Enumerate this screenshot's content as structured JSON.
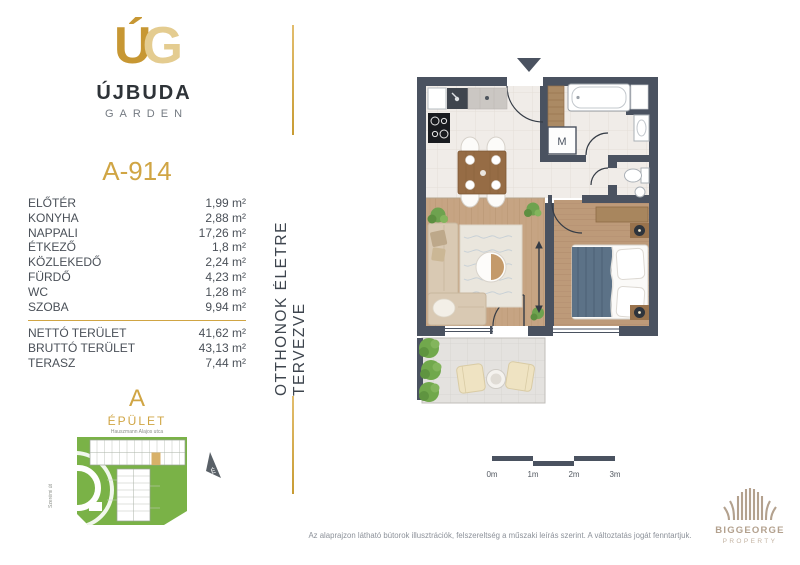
{
  "brand": {
    "monogram": [
      "Ú",
      "G"
    ],
    "name": "ÚJBUDA",
    "sub": "GARDEN"
  },
  "tagline": "OTTHONOK ÉLETRE TERVEZVE",
  "unit": {
    "id": "A-914",
    "rooms": [
      {
        "label": "ELŐTÉR",
        "area": "1,99 m²"
      },
      {
        "label": "KONYHA",
        "area": "2,88 m²"
      },
      {
        "label": "NAPPALI",
        "area": "17,26 m²"
      },
      {
        "label": "ÉTKEZŐ",
        "area": "1,8 m²"
      },
      {
        "label": "KÖZLEKEDŐ",
        "area": "2,24 m²"
      },
      {
        "label": "FÜRDŐ",
        "area": "4,23 m²"
      },
      {
        "label": "WC",
        "area": "1,28 m²"
      },
      {
        "label": "SZOBA",
        "area": "9,94 m²"
      }
    ],
    "totals": [
      {
        "label": "NETTÓ TERÜLET",
        "area": "41,62 m²"
      },
      {
        "label": "BRUTTÓ TERÜLET",
        "area": "43,13 m²"
      },
      {
        "label": "TERASZ",
        "area": "7,44 m²"
      }
    ]
  },
  "site": {
    "building_letter": "A",
    "building_label": "ÉPÜLET",
    "street_top": "Hauszmann Alajos utca",
    "street_left": "Szerémi út",
    "compass": "É"
  },
  "floorplan": {
    "washer_label": "M"
  },
  "scalebar": {
    "labels": [
      "0m",
      "1m",
      "2m",
      "3m"
    ]
  },
  "disclaimer": "Az alaprajzon látható bútorok illusztrációk, felszereltség a műszaki leírás szerint. A változtatás jogát fenntartjuk.",
  "publisher": {
    "name": "BIGGEORGE",
    "division": "PROPERTY"
  },
  "colors": {
    "gold": "#D0A544",
    "wall": "#4A5260",
    "map_green": "#7AB247",
    "logo_tan": "#B3A18E",
    "text_dark": "#4A5058"
  }
}
